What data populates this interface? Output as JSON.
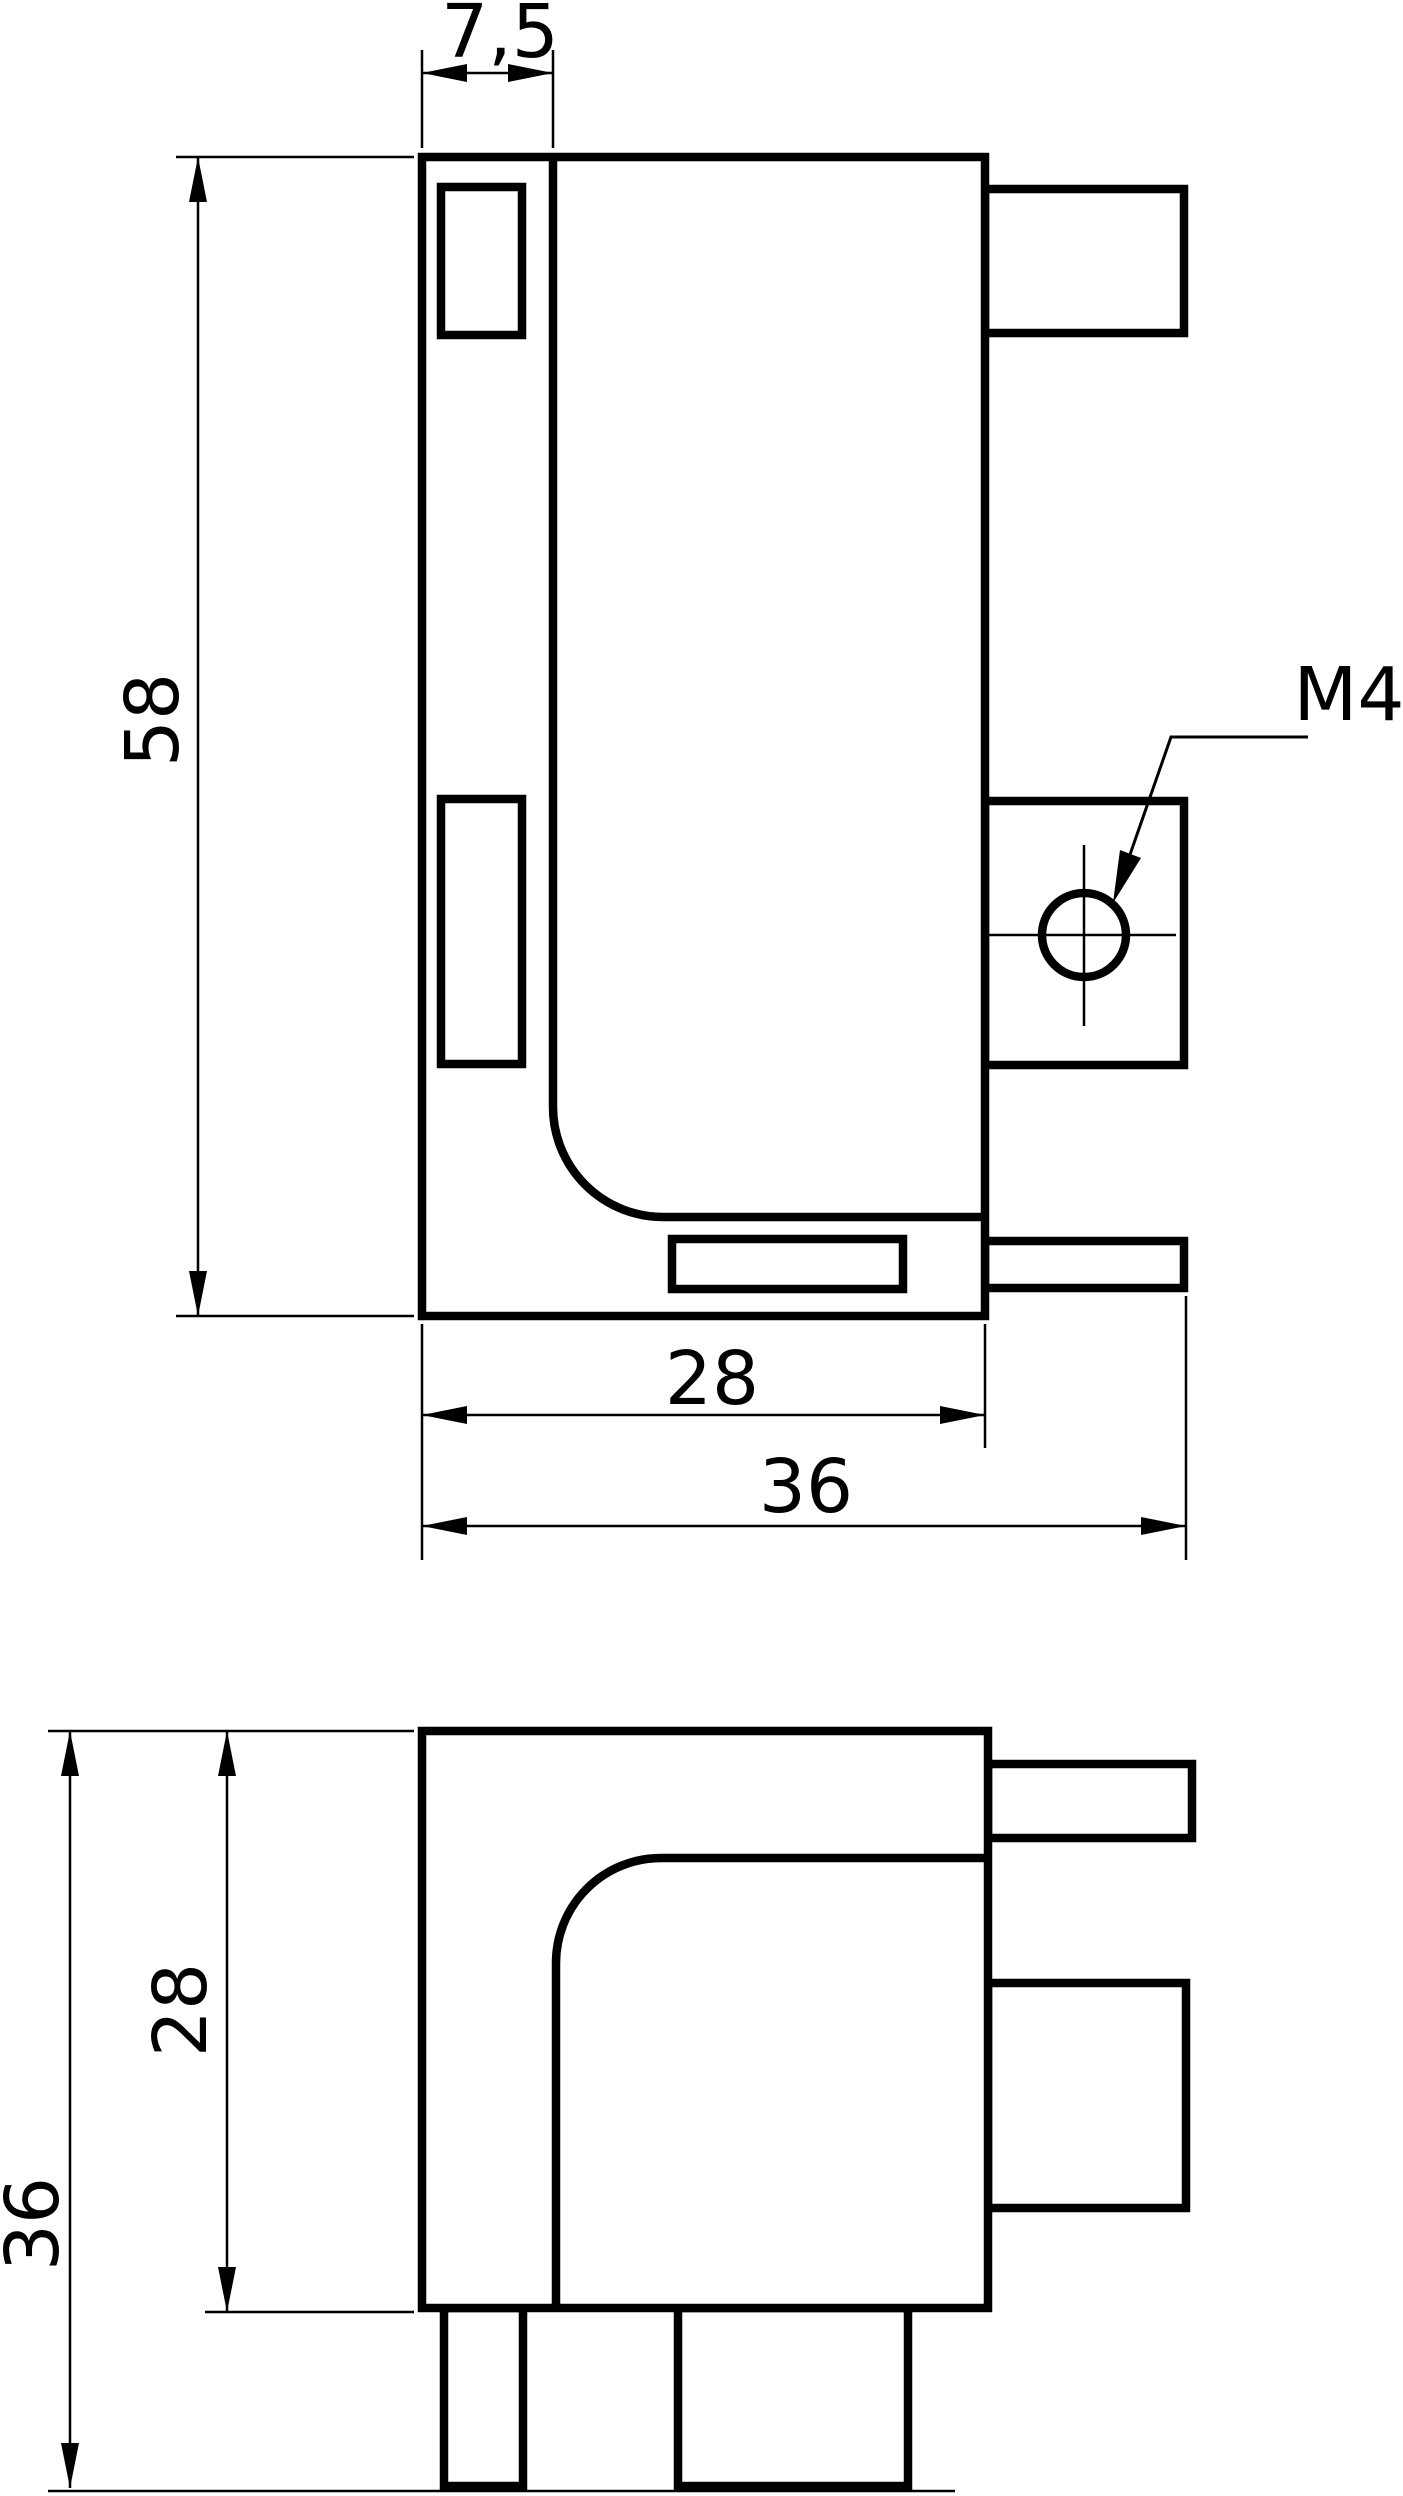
{
  "colors": {
    "line": "#000000",
    "background": "#ffffff"
  },
  "front_view": {
    "dim_slot_width": "7,5",
    "dim_height": "58",
    "dim_body_width": "28",
    "dim_total_width": "36",
    "thread_label": "M4"
  },
  "side_view": {
    "dim_body_height": "28",
    "dim_total_height": "36"
  }
}
